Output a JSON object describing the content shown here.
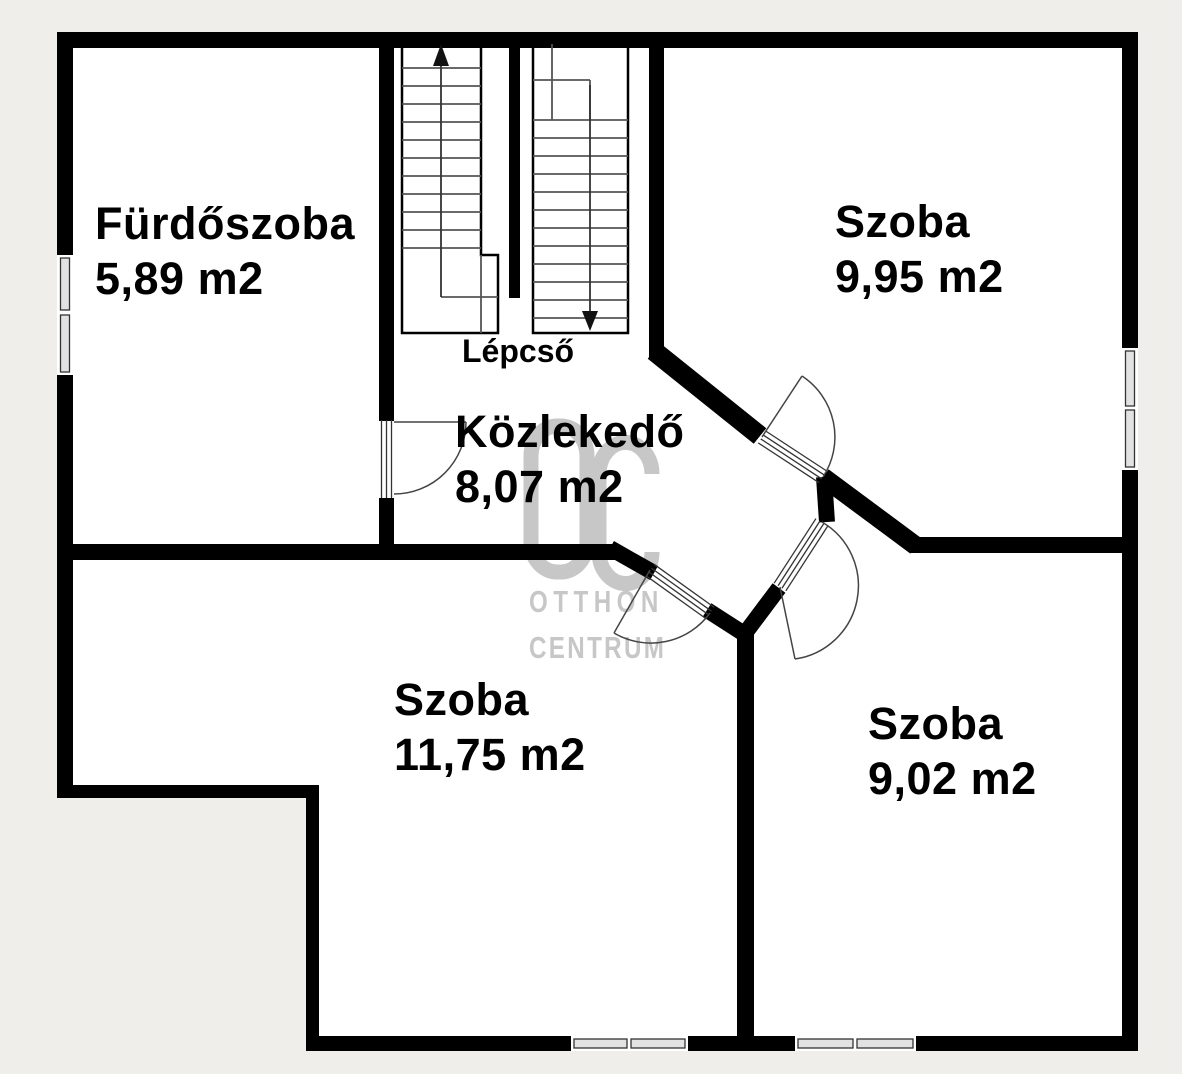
{
  "meta": {
    "type": "floor-plan",
    "language": "hu"
  },
  "colors": {
    "background": "#f0eeea",
    "floor": "#ffffff",
    "wall": "#000000",
    "stair_step_line": "#555555",
    "watermark": "#c7c7c7"
  },
  "watermark": {
    "monogram": "OC",
    "line1": "OTTHON",
    "line2": "CENTRUM"
  },
  "stairs": {
    "label": "Lépcső",
    "up_arrow_icon": "arrow-up",
    "down_arrow_icon": "arrow-down"
  },
  "rooms": {
    "furdoszoba": {
      "name": "Fürdőszoba",
      "area": "5,89 m2"
    },
    "szoba_ne": {
      "name": "Szoba",
      "area": "9,95 m2"
    },
    "kozlekedo": {
      "name": "Közlekedő",
      "area": "8,07 m2"
    },
    "szoba_sw": {
      "name": "Szoba",
      "area": "11,75 m2"
    },
    "szoba_se": {
      "name": "Szoba",
      "area": "9,02 m2"
    }
  }
}
